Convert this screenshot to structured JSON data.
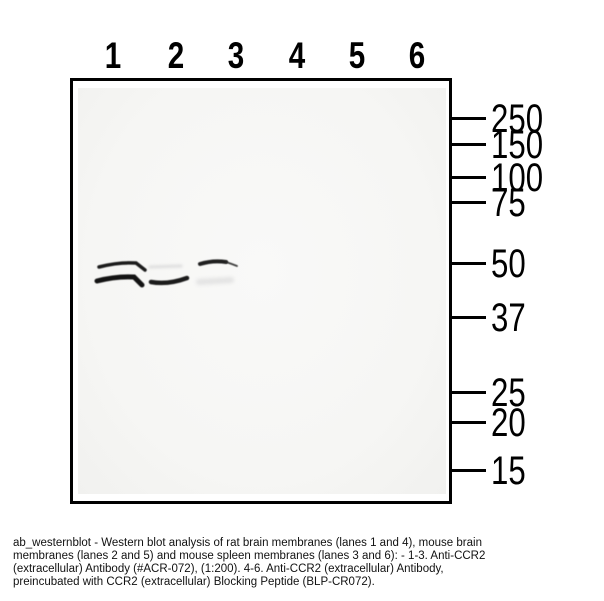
{
  "figure": {
    "type": "western_blot",
    "lanes": {
      "labels": [
        "1",
        "2",
        "3",
        "4",
        "5",
        "6"
      ],
      "x_centers": [
        113,
        176,
        236,
        297,
        357,
        417
      ]
    },
    "mw_markers": {
      "unit": "kDa",
      "items": [
        {
          "label": "250",
          "tick_y": 118
        },
        {
          "label": "150",
          "tick_y": 144
        },
        {
          "label": "100",
          "tick_y": 177
        },
        {
          "label": "75",
          "tick_y": 202
        },
        {
          "label": "50",
          "tick_y": 263
        },
        {
          "label": "37",
          "tick_y": 317
        },
        {
          "label": "25",
          "tick_y": 392
        },
        {
          "label": "20",
          "tick_y": 422
        },
        {
          "label": "15",
          "tick_y": 470
        }
      ]
    },
    "bands": [
      {
        "lane": "1",
        "kda_region": "50",
        "intensity": "strong",
        "path": {
          "x1": 99,
          "y1": 267,
          "cx": 118,
          "cy": 262,
          "x2": 136,
          "y2": 263,
          "hx": 145,
          "hy": 270
        },
        "stroke": "#101010",
        "width": 3.5,
        "blur": 0.5,
        "opacity": 0.95
      },
      {
        "lane": "1",
        "kda_region": "48",
        "intensity": "strong",
        "path": {
          "x1": 97,
          "y1": 281,
          "cx": 116,
          "cy": 276,
          "x2": 134,
          "y2": 277,
          "hx": 142,
          "hy": 285
        },
        "stroke": "#0c0c0c",
        "width": 5,
        "blur": 0.5,
        "opacity": 0.97
      },
      {
        "lane": "2",
        "kda_region": "50",
        "intensity": "faint",
        "path": {
          "x1": 150,
          "y1": 267,
          "x2": 181,
          "y2": 266
        },
        "stroke": "#dedede",
        "width": 3,
        "blur": 1.2,
        "opacity": 1
      },
      {
        "lane": "2",
        "kda_region": "48",
        "intensity": "strong",
        "path": {
          "x1": 151,
          "y1": 282,
          "cx": 168,
          "cy": 285,
          "x2": 187,
          "y2": 278
        },
        "stroke": "#101010",
        "width": 4.5,
        "blur": 0.6,
        "opacity": 0.95
      },
      {
        "lane": "3",
        "kda_region": "50",
        "intensity": "strong",
        "path": {
          "x1": 200,
          "y1": 264,
          "cx": 213,
          "cy": 260,
          "x2": 226,
          "y2": 262
        },
        "stroke": "#141414",
        "width": 4,
        "blur": 0.6,
        "opacity": 0.95
      },
      {
        "lane": "3",
        "kda_region": "50",
        "intensity": "strong-tail",
        "path": {
          "x1": 226,
          "y1": 262,
          "cx": 232,
          "cy": 264,
          "x2": 237,
          "y2": 266
        },
        "stroke": "#2a2a2a",
        "width": 1.8,
        "blur": 0.5,
        "opacity": 0.9
      },
      {
        "lane": "3",
        "kda_region": "48",
        "intensity": "faint",
        "path": {
          "x1": 199,
          "y1": 282,
          "x2": 231,
          "y2": 280
        },
        "stroke": "#e3e3e3",
        "width": 6,
        "blur": 1.8,
        "opacity": 1
      }
    ],
    "caption": {
      "lines": [
        "ab_westernblot - Western blot analysis of rat brain membranes (lanes 1 and 4), mouse brain",
        "membranes (lanes 2 and 5) and mouse spleen membranes (lanes 3 and 6): - 1-3. Anti-CCR2",
        "(extracellular) Antibody (#ACR-072), (1:200). 4-6. Anti-CCR2 (extracellular) Antibody,",
        "preincubated with CCR2 (extracellular) Blocking Peptide (BLP-CR072)."
      ]
    },
    "colors": {
      "border": "#000000",
      "membrane_bg": "#f6f6f4",
      "band_dark": "#101010",
      "band_faint": "#e0e0e0",
      "caption_text": "#111111"
    }
  }
}
